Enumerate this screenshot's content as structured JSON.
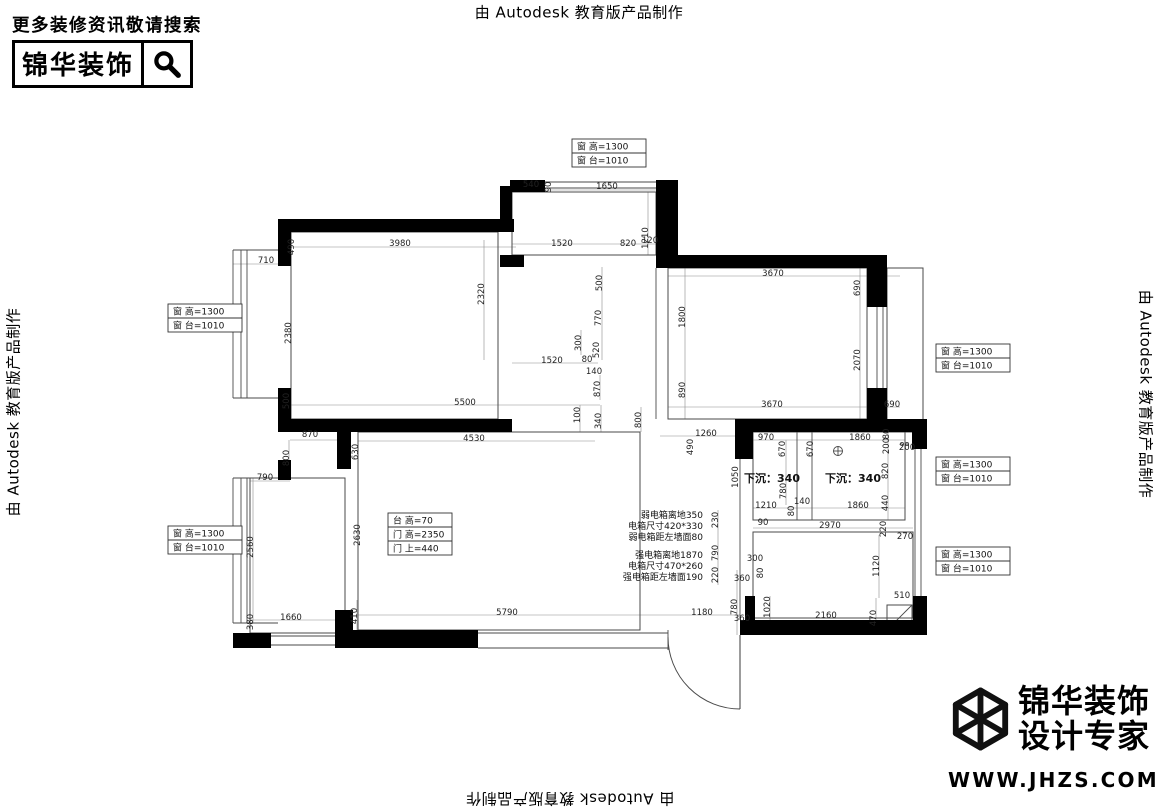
{
  "watermark": {
    "text": "由 Autodesk 教育版产品制作"
  },
  "brand_top_left": {
    "tagline": "更多装修资讯敬请搜索",
    "name": "锦华装饰"
  },
  "brand_bottom_right": {
    "line1": "锦华装饰",
    "line2": "设计专家",
    "url": "WWW.JHZS.COM"
  },
  "plan": {
    "wall_color": "#000000",
    "line_color": "#4a4a4a",
    "dimline_color": "#8c8c8c",
    "dim_color": "#222222",
    "walls": [
      [
        278,
        219,
        236,
        13
      ],
      [
        278,
        219,
        13,
        47
      ],
      [
        278,
        388,
        13,
        44
      ],
      [
        500,
        186,
        12,
        46
      ],
      [
        510,
        180,
        35,
        12
      ],
      [
        656,
        180,
        22,
        88
      ],
      [
        500,
        255,
        24,
        12
      ],
      [
        278,
        419,
        234,
        13
      ],
      [
        337,
        419,
        14,
        50
      ],
      [
        656,
        255,
        224,
        13
      ],
      [
        867,
        255,
        20,
        52
      ],
      [
        867,
        388,
        20,
        44
      ],
      [
        735,
        419,
        192,
        13
      ],
      [
        912,
        419,
        15,
        30
      ],
      [
        735,
        419,
        18,
        40
      ],
      [
        913,
        596,
        14,
        39
      ],
      [
        740,
        620,
        180,
        15
      ],
      [
        348,
        630,
        130,
        18
      ],
      [
        335,
        610,
        18,
        38
      ],
      [
        233,
        633,
        38,
        15
      ],
      [
        278,
        460,
        13,
        20
      ],
      [
        745,
        596,
        10,
        34
      ]
    ],
    "rooms": [
      [
        512,
        192,
        144,
        63
      ],
      [
        291,
        232,
        207,
        187
      ],
      [
        668,
        268,
        199,
        151
      ],
      [
        887,
        268,
        36,
        164
      ],
      [
        753,
        432,
        152,
        88
      ],
      [
        753,
        532,
        160,
        86
      ],
      [
        250,
        478,
        95,
        155
      ],
      [
        358,
        432,
        282,
        198
      ],
      [
        887,
        605,
        25,
        25
      ]
    ],
    "lines": [
      [
        233,
        250,
        233,
        398
      ],
      [
        241,
        250,
        241,
        398
      ],
      [
        247,
        250,
        247,
        398
      ],
      [
        233,
        250,
        278,
        250
      ],
      [
        233,
        398,
        278,
        398
      ],
      [
        233,
        478,
        233,
        623
      ],
      [
        241,
        478,
        241,
        623
      ],
      [
        247,
        478,
        247,
        623
      ],
      [
        233,
        478,
        278,
        478
      ],
      [
        233,
        623,
        278,
        623
      ],
      [
        545,
        182,
        656,
        182
      ],
      [
        545,
        188,
        656,
        188
      ],
      [
        877,
        307,
        877,
        390
      ],
      [
        883,
        307,
        883,
        390
      ],
      [
        915,
        448,
        915,
        596
      ],
      [
        921,
        448,
        921,
        596
      ],
      [
        797,
        432,
        797,
        520
      ],
      [
        812,
        432,
        812,
        520
      ],
      [
        656,
        268,
        656,
        419
      ],
      [
        668,
        268,
        668,
        419
      ],
      [
        740,
        432,
        740,
        620
      ],
      [
        478,
        633,
        668,
        633
      ],
      [
        478,
        648,
        668,
        648
      ],
      [
        668,
        630,
        668,
        650
      ],
      [
        271,
        636,
        335,
        636
      ],
      [
        271,
        645,
        335,
        645
      ],
      [
        887,
        432,
        923,
        432
      ],
      [
        833,
        451,
        843,
        451
      ],
      [
        838,
        446,
        838,
        456
      ],
      [
        887,
        630,
        912,
        605
      ]
    ],
    "dimlines": [
      [
        545,
        190,
        656,
        190
      ],
      [
        512,
        244,
        660,
        244
      ],
      [
        285,
        247,
        516,
        247
      ],
      [
        233,
        264,
        291,
        264
      ],
      [
        285,
        405,
        600,
        405
      ],
      [
        602,
        267,
        602,
        360
      ],
      [
        512,
        363,
        598,
        363
      ],
      [
        291,
        247,
        291,
        398
      ],
      [
        648,
        192,
        648,
        255
      ],
      [
        668,
        276,
        900,
        276
      ],
      [
        685,
        268,
        685,
        419
      ],
      [
        860,
        268,
        860,
        419
      ],
      [
        668,
        407,
        900,
        407
      ],
      [
        290,
        440,
        340,
        440
      ],
      [
        358,
        441,
        595,
        441
      ],
      [
        641,
        407,
        641,
        432
      ],
      [
        660,
        436,
        740,
        436
      ],
      [
        753,
        440,
        905,
        440
      ],
      [
        753,
        508,
        905,
        508
      ],
      [
        888,
        432,
        888,
        520
      ],
      [
        753,
        528,
        913,
        528
      ],
      [
        879,
        535,
        879,
        598
      ],
      [
        718,
        510,
        718,
        585
      ],
      [
        253,
        478,
        253,
        623
      ],
      [
        250,
        481,
        290,
        481
      ],
      [
        250,
        620,
        345,
        620
      ],
      [
        357,
        600,
        357,
        633
      ],
      [
        358,
        615,
        740,
        615
      ],
      [
        755,
        618,
        870,
        618
      ],
      [
        876,
        598,
        876,
        632
      ],
      [
        737,
        570,
        737,
        635
      ],
      [
        770,
        596,
        770,
        630
      ],
      [
        484,
        240,
        484,
        360
      ],
      [
        580,
        405,
        580,
        432
      ],
      [
        601,
        405,
        601,
        432
      ],
      [
        600,
        375,
        600,
        400
      ],
      [
        581,
        330,
        581,
        355
      ],
      [
        786,
        440,
        786,
        505
      ],
      [
        289,
        388,
        289,
        432
      ],
      [
        289,
        440,
        289,
        470
      ]
    ],
    "dims": [
      {
        "t": "540",
        "x": 531,
        "y": 187
      },
      {
        "t": "90",
        "x": 551,
        "y": 187,
        "v": 1
      },
      {
        "t": "1650",
        "x": 607,
        "y": 189
      },
      {
        "t": "1210",
        "x": 648,
        "y": 238,
        "v": 1
      },
      {
        "t": "1520",
        "x": 562,
        "y": 246
      },
      {
        "t": "820",
        "x": 628,
        "y": 246
      },
      {
        "t": "120",
        "x": 650,
        "y": 243
      },
      {
        "t": "490",
        "x": 294,
        "y": 247,
        "v": 1
      },
      {
        "t": "3980",
        "x": 400,
        "y": 246
      },
      {
        "t": "710",
        "x": 266,
        "y": 263
      },
      {
        "t": "2320",
        "x": 484,
        "y": 294,
        "v": 1
      },
      {
        "t": "500",
        "x": 602,
        "y": 283,
        "v": 1
      },
      {
        "t": "770",
        "x": 601,
        "y": 318,
        "v": 1
      },
      {
        "t": "300",
        "x": 581,
        "y": 343,
        "v": 1
      },
      {
        "t": "520",
        "x": 599,
        "y": 350,
        "v": 1
      },
      {
        "t": "2380",
        "x": 291,
        "y": 333,
        "v": 1
      },
      {
        "t": "1520",
        "x": 552,
        "y": 363
      },
      {
        "t": "80",
        "x": 587,
        "y": 362
      },
      {
        "t": "3670",
        "x": 773,
        "y": 276
      },
      {
        "t": "690",
        "x": 860,
        "y": 288,
        "v": 1
      },
      {
        "t": "1800",
        "x": 685,
        "y": 317,
        "v": 1
      },
      {
        "t": "2070",
        "x": 860,
        "y": 360,
        "v": 1
      },
      {
        "t": "890",
        "x": 685,
        "y": 390,
        "v": 1
      },
      {
        "t": "3670",
        "x": 772,
        "y": 407
      },
      {
        "t": "690",
        "x": 892,
        "y": 407
      },
      {
        "t": "500",
        "x": 289,
        "y": 401,
        "v": 1
      },
      {
        "t": "5500",
        "x": 465,
        "y": 405
      },
      {
        "t": "140",
        "x": 594,
        "y": 374
      },
      {
        "t": "870",
        "x": 600,
        "y": 389,
        "v": 1
      },
      {
        "t": "100",
        "x": 580,
        "y": 415,
        "v": 1
      },
      {
        "t": "340",
        "x": 601,
        "y": 421,
        "v": 1
      },
      {
        "t": "800",
        "x": 641,
        "y": 420,
        "v": 1
      },
      {
        "t": "1260",
        "x": 706,
        "y": 436
      },
      {
        "t": "490",
        "x": 693,
        "y": 447,
        "v": 1
      },
      {
        "t": "870",
        "x": 310,
        "y": 437
      },
      {
        "t": "800",
        "x": 289,
        "y": 458,
        "v": 1
      },
      {
        "t": "630",
        "x": 358,
        "y": 452,
        "v": 1
      },
      {
        "t": "4530",
        "x": 474,
        "y": 441
      },
      {
        "t": "970",
        "x": 766,
        "y": 440
      },
      {
        "t": "670",
        "x": 785,
        "y": 449,
        "v": 1
      },
      {
        "t": "670",
        "x": 813,
        "y": 449,
        "v": 1
      },
      {
        "t": "1860",
        "x": 860,
        "y": 440
      },
      {
        "t": "80",
        "x": 889,
        "y": 434,
        "v": 1
      },
      {
        "t": "200",
        "x": 889,
        "y": 446,
        "v": 1
      },
      {
        "t": "200",
        "x": 907,
        "y": 450
      },
      {
        "t": "820",
        "x": 888,
        "y": 471,
        "v": 1
      },
      {
        "t": "440",
        "x": 888,
        "y": 503,
        "v": 1
      },
      {
        "t": "780",
        "x": 786,
        "y": 491,
        "v": 1
      },
      {
        "t": "1210",
        "x": 766,
        "y": 508
      },
      {
        "t": "140",
        "x": 802,
        "y": 504
      },
      {
        "t": "80",
        "x": 794,
        "y": 511,
        "v": 1
      },
      {
        "t": "1860",
        "x": 858,
        "y": 508
      },
      {
        "t": "1050",
        "x": 738,
        "y": 477,
        "v": 1
      },
      {
        "t": "2630",
        "x": 360,
        "y": 535,
        "v": 1
      },
      {
        "t": "790",
        "x": 265,
        "y": 480
      },
      {
        "t": "2560",
        "x": 253,
        "y": 547,
        "v": 1
      },
      {
        "t": "380",
        "x": 253,
        "y": 622,
        "v": 1
      },
      {
        "t": "1660",
        "x": 291,
        "y": 620
      },
      {
        "t": "410",
        "x": 357,
        "y": 616,
        "v": 1
      },
      {
        "t": "5790",
        "x": 507,
        "y": 615
      },
      {
        "t": "1180",
        "x": 702,
        "y": 615
      },
      {
        "t": "230",
        "x": 718,
        "y": 520,
        "v": 1
      },
      {
        "t": "790",
        "x": 718,
        "y": 553,
        "v": 1
      },
      {
        "t": "220",
        "x": 718,
        "y": 575,
        "v": 1
      },
      {
        "t": "90",
        "x": 763,
        "y": 525
      },
      {
        "t": "2970",
        "x": 830,
        "y": 528
      },
      {
        "t": "220",
        "x": 886,
        "y": 529,
        "v": 1
      },
      {
        "t": "270",
        "x": 905,
        "y": 539
      },
      {
        "t": "1120",
        "x": 879,
        "y": 566,
        "v": 1
      },
      {
        "t": "300",
        "x": 755,
        "y": 561
      },
      {
        "t": "80",
        "x": 763,
        "y": 573,
        "v": 1
      },
      {
        "t": "360",
        "x": 742,
        "y": 581
      },
      {
        "t": "780",
        "x": 737,
        "y": 607,
        "v": 1
      },
      {
        "t": "360",
        "x": 742,
        "y": 621
      },
      {
        "t": "1020",
        "x": 770,
        "y": 607,
        "v": 1
      },
      {
        "t": "2160",
        "x": 826,
        "y": 618
      },
      {
        "t": "470",
        "x": 876,
        "y": 618,
        "v": 1
      },
      {
        "t": "510",
        "x": 902,
        "y": 598
      }
    ],
    "boxes": [
      {
        "x": 572,
        "y": 139,
        "w": 74,
        "rows": [
          "窗 高=1300",
          "窗 台=1010"
        ]
      },
      {
        "x": 168,
        "y": 304,
        "w": 74,
        "rows": [
          "窗 高=1300",
          "窗 台=1010"
        ]
      },
      {
        "x": 168,
        "y": 526,
        "w": 74,
        "rows": [
          "窗 高=1300",
          "窗 台=1010"
        ]
      },
      {
        "x": 936,
        "y": 344,
        "w": 74,
        "rows": [
          "窗 高=1300",
          "窗 台=1010"
        ]
      },
      {
        "x": 936,
        "y": 457,
        "w": 74,
        "rows": [
          "窗 高=1300",
          "窗 台=1010"
        ]
      },
      {
        "x": 936,
        "y": 547,
        "w": 74,
        "rows": [
          "窗 高=1300",
          "窗 台=1010"
        ]
      },
      {
        "x": 388,
        "y": 513,
        "w": 64,
        "rows": [
          "台 高=70",
          "门 高=2350",
          "门 上=440"
        ]
      }
    ],
    "labels": [
      {
        "t": "下沉：340",
        "x": 772,
        "y": 482,
        "a": "middle",
        "s": 11,
        "b": 1
      },
      {
        "t": "下沉：340",
        "x": 853,
        "y": 482,
        "a": "middle",
        "s": 11,
        "b": 1
      },
      {
        "t": "弱电箱离地350",
        "x": 703,
        "y": 518,
        "a": "end",
        "s": 9
      },
      {
        "t": "电箱尺寸420*330",
        "x": 703,
        "y": 529,
        "a": "end",
        "s": 9
      },
      {
        "t": "弱电箱距左墙面80",
        "x": 703,
        "y": 540,
        "a": "end",
        "s": 9
      },
      {
        "t": "强电箱离地1870",
        "x": 703,
        "y": 558,
        "a": "end",
        "s": 9
      },
      {
        "t": "电箱尺寸470*260",
        "x": 703,
        "y": 569,
        "a": "end",
        "s": 9
      },
      {
        "t": "强电箱距左墙面190",
        "x": 703,
        "y": 580,
        "a": "end",
        "s": 9
      }
    ],
    "circles": [
      [
        902,
        444,
        1.6
      ],
      [
        907,
        444,
        1.6
      ],
      [
        838,
        451,
        4.5
      ]
    ],
    "door": {
      "leaf": [
        740,
        635,
        740,
        709
      ],
      "arc": "M 668 637 A 72 72 0 0 0 740 709"
    }
  }
}
